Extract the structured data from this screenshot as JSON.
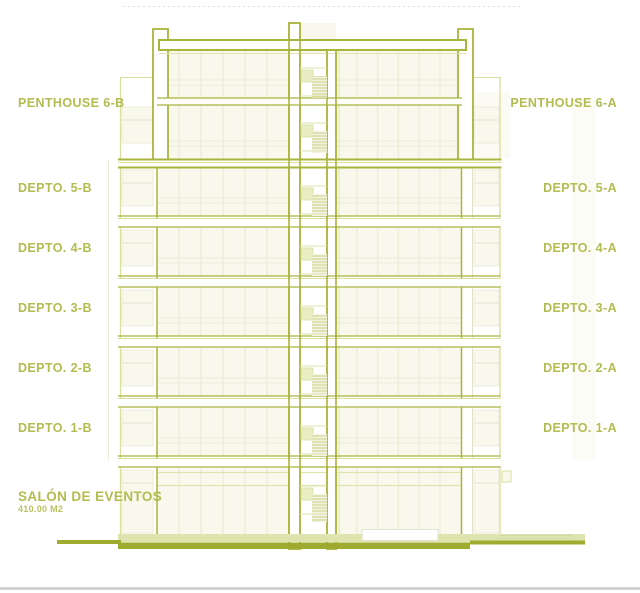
{
  "colors": {
    "olive": "#a9b43c",
    "olive_dark": "#9eab2e",
    "olive_light": "#d9df9f",
    "pale_line": "#dfe3ad",
    "cream": "#f8f8ed",
    "cream_line": "#ececd8",
    "pale_fill": "#e9edc4",
    "hatch_line": "#ccd386",
    "ground_band": "#dee4ae",
    "text": "#b2bc4f",
    "gray_line": "#cbcbcb"
  },
  "floor_labels_left": [
    {
      "text": "PENTHOUSE 6-B",
      "y": 96
    },
    {
      "text": "DEPTO. 5-B",
      "y": 181
    },
    {
      "text": "DEPTO. 4-B",
      "y": 241
    },
    {
      "text": "DEPTO. 3-B",
      "y": 301
    },
    {
      "text": "DEPTO. 2-B",
      "y": 361
    },
    {
      "text": "DEPTO. 1-B",
      "y": 421
    }
  ],
  "floor_labels_right": [
    {
      "text": "PENTHOUSE 6-A",
      "y": 96
    },
    {
      "text": "DEPTO. 5-A",
      "y": 181
    },
    {
      "text": "DEPTO. 4-A",
      "y": 241
    },
    {
      "text": "DEPTO. 3-A",
      "y": 301
    },
    {
      "text": "DEPTO. 2-A",
      "y": 361
    },
    {
      "text": "DEPTO. 1-A",
      "y": 421
    }
  ],
  "salon": {
    "title": "SALÓN DE EVENTOS",
    "area": "410.00 M2"
  }
}
